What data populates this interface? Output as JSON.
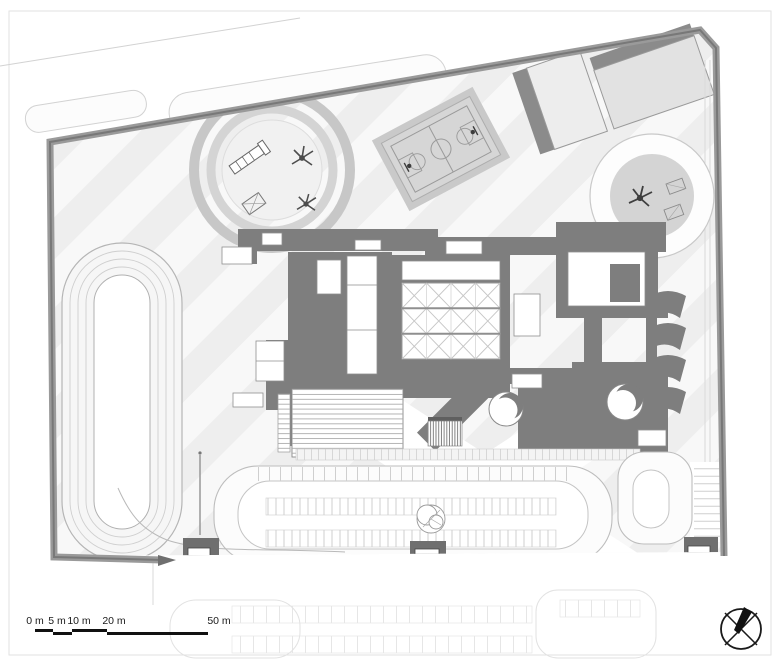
{
  "colors": {
    "roof_dark": "#7e7e7e",
    "roof_mid": "#8b8b8b",
    "boundary": "#9a9a9a",
    "boundary_core": "#787878",
    "court_fill": "#d6d6d6",
    "stripe_light": "#ebebeb",
    "ink": "#1a1a1a"
  },
  "scale_bar": {
    "labels": [
      "0 m",
      "5 m",
      "10 m",
      "20 m",
      "50 m"
    ]
  },
  "icons": {
    "north_arrow": "circle-cross-compass"
  }
}
